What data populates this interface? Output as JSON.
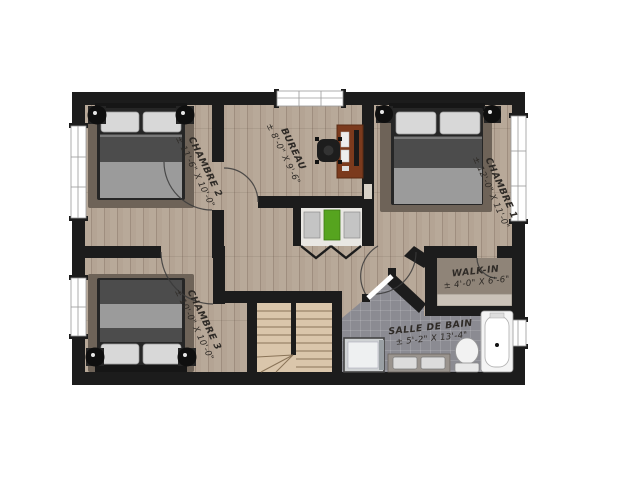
{
  "plan_title": "floor-plan-etage",
  "rooms": [
    {
      "id": "chambre1",
      "name": "CHAMBRE 1",
      "dims": "± 12'-0\" X 11'-0\""
    },
    {
      "id": "chambre2",
      "name": "CHAMBRE 2",
      "dims": "± 11'-6\" X 10'-0\""
    },
    {
      "id": "chambre3",
      "name": "CHAMBRE 3",
      "dims": "± 10'-0\" X 10'-0\""
    },
    {
      "id": "bureau",
      "name": "BUREAU",
      "dims": "± 8'-0\" X 9'-6\""
    },
    {
      "id": "walk_in",
      "name": "WALK-IN",
      "dims": "± 4'-0\" X 6'-6\""
    },
    {
      "id": "salle_de_bain",
      "name": "SALLE DE BAIN",
      "dims": "± 5'-2\" X 13'-4\""
    }
  ],
  "palette": {
    "wall": "#1c1c1c",
    "wood": "#b4a494",
    "tile": "#8b8b92",
    "stairs": "#dac6ab",
    "stair_line": "#8a7458",
    "walkin": "#8f8478",
    "shelf": "#cac2b8",
    "closet": "#e9e7e3",
    "rug": "#6e6358",
    "bed_dark": "#4c4c4c",
    "bed_mid": "#9b9b9b",
    "pillow": "#d8d8d8",
    "frame_dark": "#262626",
    "desk": "#7b3a1d",
    "chair": "#1d1d1d",
    "green": "#56a41f",
    "fixture": "#f2f2f2",
    "fixture_line": "#9a9a9a",
    "vanity": "#9a948e",
    "sink": "#dcdcdc",
    "glass": "#cfd2d4",
    "ink": "#2e2a26",
    "arc": "#3a3a3a"
  }
}
